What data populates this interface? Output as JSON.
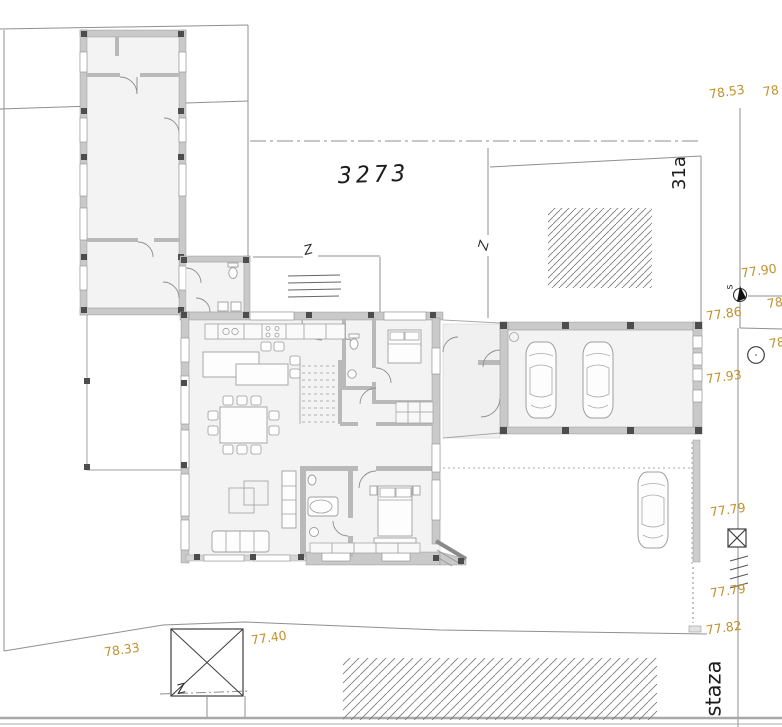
{
  "labels": {
    "parcel_number": "3273",
    "house_number": "31a",
    "path_name": "staza",
    "benchmark_letter": "s",
    "break_symbol": "Z"
  },
  "spot_heights": [
    "78.53",
    "78",
    "77.90",
    "77.86",
    "78",
    "78",
    "77.93",
    "77.79",
    "77.79",
    "77.82",
    "78.33",
    "77.40"
  ],
  "colors": {
    "spot_text": "#c0922e",
    "ink": "#1c1c1c",
    "boundary": "#8f8f8f",
    "wall_fill": "#c9c9c9",
    "wall_edge": "#8a8a8a",
    "column": "#4d4d4d",
    "floor": "#f3f3f3",
    "furniture": "#9f9f9f",
    "hatch": "#7d7d7d"
  }
}
